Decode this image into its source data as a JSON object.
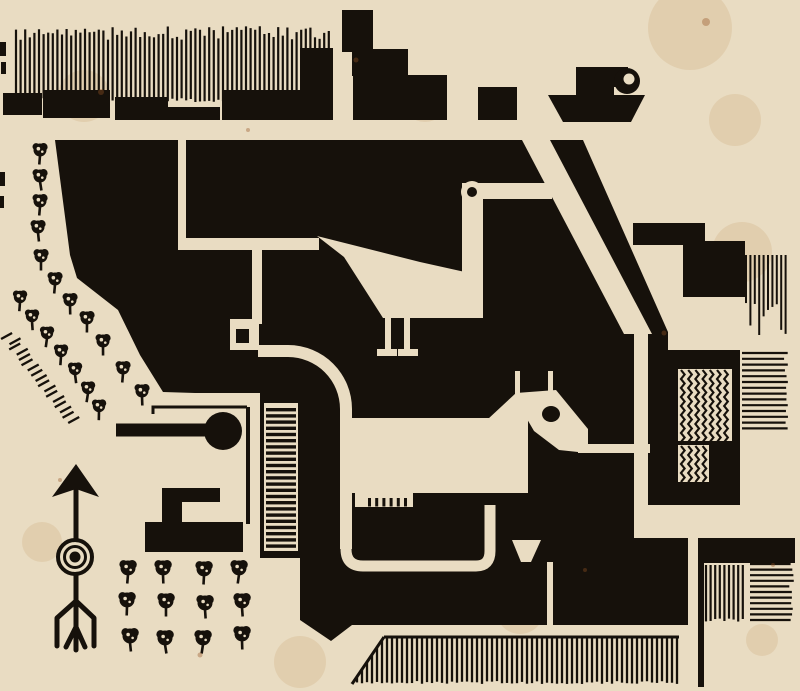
{
  "artwork": {
    "kind": "woodcut-town-plan-print",
    "figures": [
      "steamboat",
      "goose",
      "horse",
      "north-arrow",
      "orchard",
      "tree-rows"
    ]
  },
  "palette": {
    "paper": "#e9dcc2",
    "paper_shade": "#e3d2b1",
    "ink": "#16110b",
    "stain": "rgba(186,134,74,0.16)",
    "fox": "rgba(150,84,38,0.38)"
  },
  "generators": {
    "harbor_hatch": {
      "x0": 16,
      "x1": 331,
      "step": 4.6,
      "y_top": 26,
      "top_jitter": 14,
      "y_bot": 98,
      "stroke": 2.2
    },
    "ladder_rungs": {
      "x": 266,
      "w": 30,
      "y0": 408,
      "y1": 548,
      "step": 6.2,
      "h": 3.4
    },
    "herringbone": [
      {
        "x": 678,
        "y": 369,
        "w": 54,
        "h": 72
      },
      {
        "x": 678,
        "y": 445,
        "w": 31,
        "h": 37
      }
    ],
    "chevron": {
      "col_step": 7.2,
      "period": 9,
      "amp": 3.6,
      "stroke": 2.2
    },
    "hatch_panels": [
      {
        "type": "h",
        "x": 742,
        "y": 353,
        "w": 47,
        "h": 80,
        "step": 5.8,
        "stroke": 2.2
      },
      {
        "type": "v",
        "x": 746,
        "y": 255,
        "w": 41,
        "h": 82,
        "step": 4.4,
        "stroke": 2.0,
        "vary": 1
      },
      {
        "type": "v",
        "x": 706,
        "y": 565,
        "w": 40,
        "h": 57,
        "step": 4.6,
        "stroke": 2.2
      },
      {
        "type": "h",
        "x": 750,
        "y": 564,
        "w": 44,
        "h": 60,
        "step": 5.6,
        "stroke": 2.2
      }
    ],
    "bottom_strip": {
      "x0": 352,
      "x1": 679,
      "step": 5,
      "y_top": 637,
      "y_bot": 684,
      "slant_until": 384,
      "stroke": 2.3
    },
    "hedge_dashes": {
      "x0": 8,
      "y0": 336,
      "x1": 74,
      "y1": 420,
      "count": 17,
      "len": 11,
      "stroke": 2.4
    },
    "stains": [
      [
        690,
        28,
        42
      ],
      [
        84,
        96,
        26
      ],
      [
        742,
        252,
        30
      ],
      [
        425,
        100,
        22
      ],
      [
        645,
        430,
        18
      ],
      [
        300,
        662,
        26
      ],
      [
        42,
        542,
        20
      ],
      [
        762,
        640,
        16
      ],
      [
        210,
        300,
        30
      ],
      [
        520,
        610,
        24
      ],
      [
        735,
        120,
        26
      ]
    ],
    "foxing": [
      [
        706,
        22,
        4
      ],
      [
        101,
        92,
        3
      ],
      [
        664,
        333,
        2.5
      ],
      [
        585,
        570,
        2
      ],
      [
        773,
        565,
        2
      ],
      [
        200,
        655,
        2.5
      ],
      [
        60,
        480,
        2
      ],
      [
        356,
        60,
        2.5
      ],
      [
        248,
        130,
        2
      ]
    ]
  },
  "trees": {
    "inner_row": [
      [
        40,
        150
      ],
      [
        40,
        176
      ],
      [
        40,
        201
      ],
      [
        38,
        227
      ],
      [
        41,
        256
      ],
      [
        55,
        279
      ],
      [
        70,
        300
      ],
      [
        87,
        318
      ],
      [
        103,
        341
      ],
      [
        123,
        368
      ],
      [
        142,
        391
      ]
    ],
    "outer_row": [
      [
        20,
        297
      ],
      [
        32,
        316
      ],
      [
        47,
        333
      ],
      [
        61,
        351
      ],
      [
        75,
        369
      ],
      [
        88,
        388
      ],
      [
        99,
        406
      ]
    ],
    "orchard_grid": [
      [
        128,
        568
      ],
      [
        163,
        568
      ],
      [
        204,
        569
      ],
      [
        239,
        568
      ],
      [
        127,
        600
      ],
      [
        166,
        601
      ],
      [
        205,
        603
      ],
      [
        242,
        601
      ],
      [
        130,
        636
      ],
      [
        165,
        638
      ],
      [
        203,
        638
      ],
      [
        242,
        634
      ]
    ]
  },
  "edge_marks": [
    [
      0,
      42,
      6,
      14
    ],
    [
      1,
      62,
      5,
      12
    ],
    [
      0,
      172,
      5,
      14
    ],
    [
      0,
      196,
      4,
      12
    ]
  ]
}
